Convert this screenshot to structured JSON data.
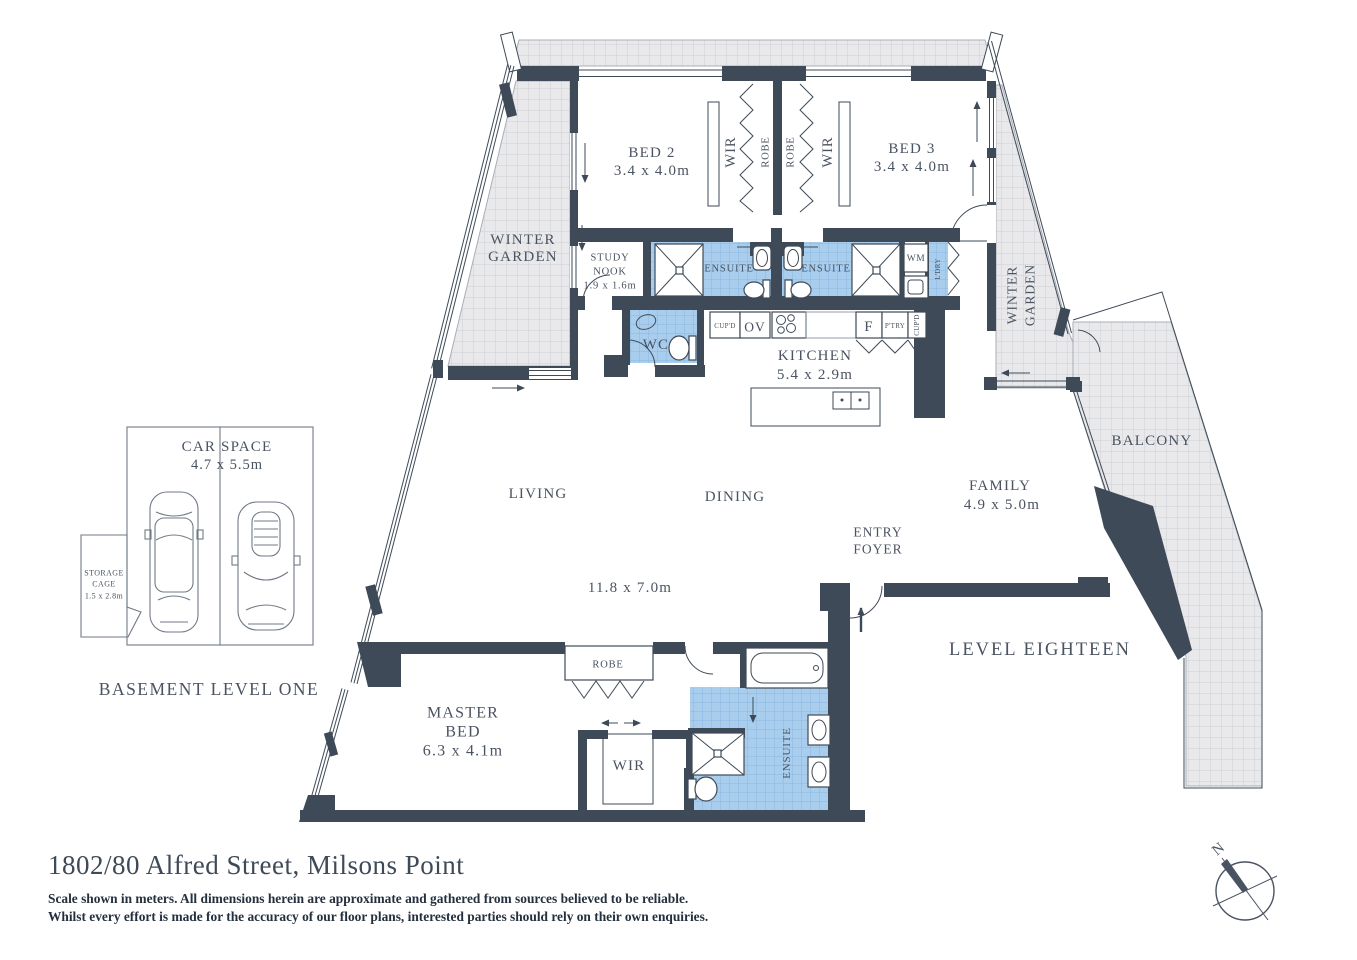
{
  "header": {
    "title": "1802/80 Alfred Street, Milsons Point",
    "disclaimer1": "Scale shown in meters. All dimensions herein are approximate and gathered from sources believed to be reliable.",
    "disclaimer2": "Whilst every effort is made for the accuracy of our floor plans, interested parties should rely on their own enquiries."
  },
  "plan": {
    "level_label": "LEVEL EIGHTEEN",
    "rooms": {
      "winter_garden_left": {
        "line1": "WINTER",
        "line2": "GARDEN"
      },
      "winter_garden_right": {
        "line1": "WINTER",
        "line2": "GARDEN"
      },
      "bed2": {
        "name": "BED 2",
        "dims": "3.4 x 4.0m"
      },
      "bed3": {
        "name": "BED 3",
        "dims": "3.4 x 4.0m"
      },
      "wir_bed2": "WIR",
      "robe_bed2": "ROBE",
      "robe_bed3": "ROBE",
      "wir_bed3": "WIR",
      "study_nook": {
        "line1": "STUDY",
        "line2": "NOOK",
        "dims": "1.9 x 1.6m"
      },
      "ensuite_bed2": "ENSUITE",
      "ensuite_bed3": "ENSUITE",
      "wm": "WM",
      "laundry": "L'DRY",
      "wc": "WC",
      "kitchen": {
        "name": "KITCHEN",
        "dims": "5.4 x 2.9m"
      },
      "cupboard_left": "CUP'D",
      "oven": "OV",
      "fridge": "F",
      "pantry": "P'TRY",
      "cupboard_right": "CUP'D",
      "living": "LIVING",
      "dining": "DINING",
      "living_dims": "11.8 x 7.0m",
      "family": {
        "name": "FAMILY",
        "dims": "4.9 x 5.0m"
      },
      "entry": {
        "line1": "ENTRY",
        "line2": "FOYER"
      },
      "balcony": "BALCONY",
      "master": {
        "line1": "MASTER",
        "line2": "BED",
        "dims": "6.3 x 4.1m"
      },
      "robe_master": "ROBE",
      "wir_master": "WIR",
      "ensuite_master": "ENSUITE"
    }
  },
  "basement": {
    "label": "BASEMENT LEVEL ONE",
    "car_space": {
      "name": "CAR SPACE",
      "dims": "4.7 x 5.5m"
    },
    "storage": {
      "line1": "STORAGE",
      "line2": "CAGE",
      "dims": "1.5 x 2.8m"
    }
  },
  "compass": {
    "north": "N"
  },
  "colors": {
    "wall": "#3E4A57",
    "tile": "#E9E9EB",
    "wet_area": "#A9CDEC",
    "text": "#4A5361"
  }
}
